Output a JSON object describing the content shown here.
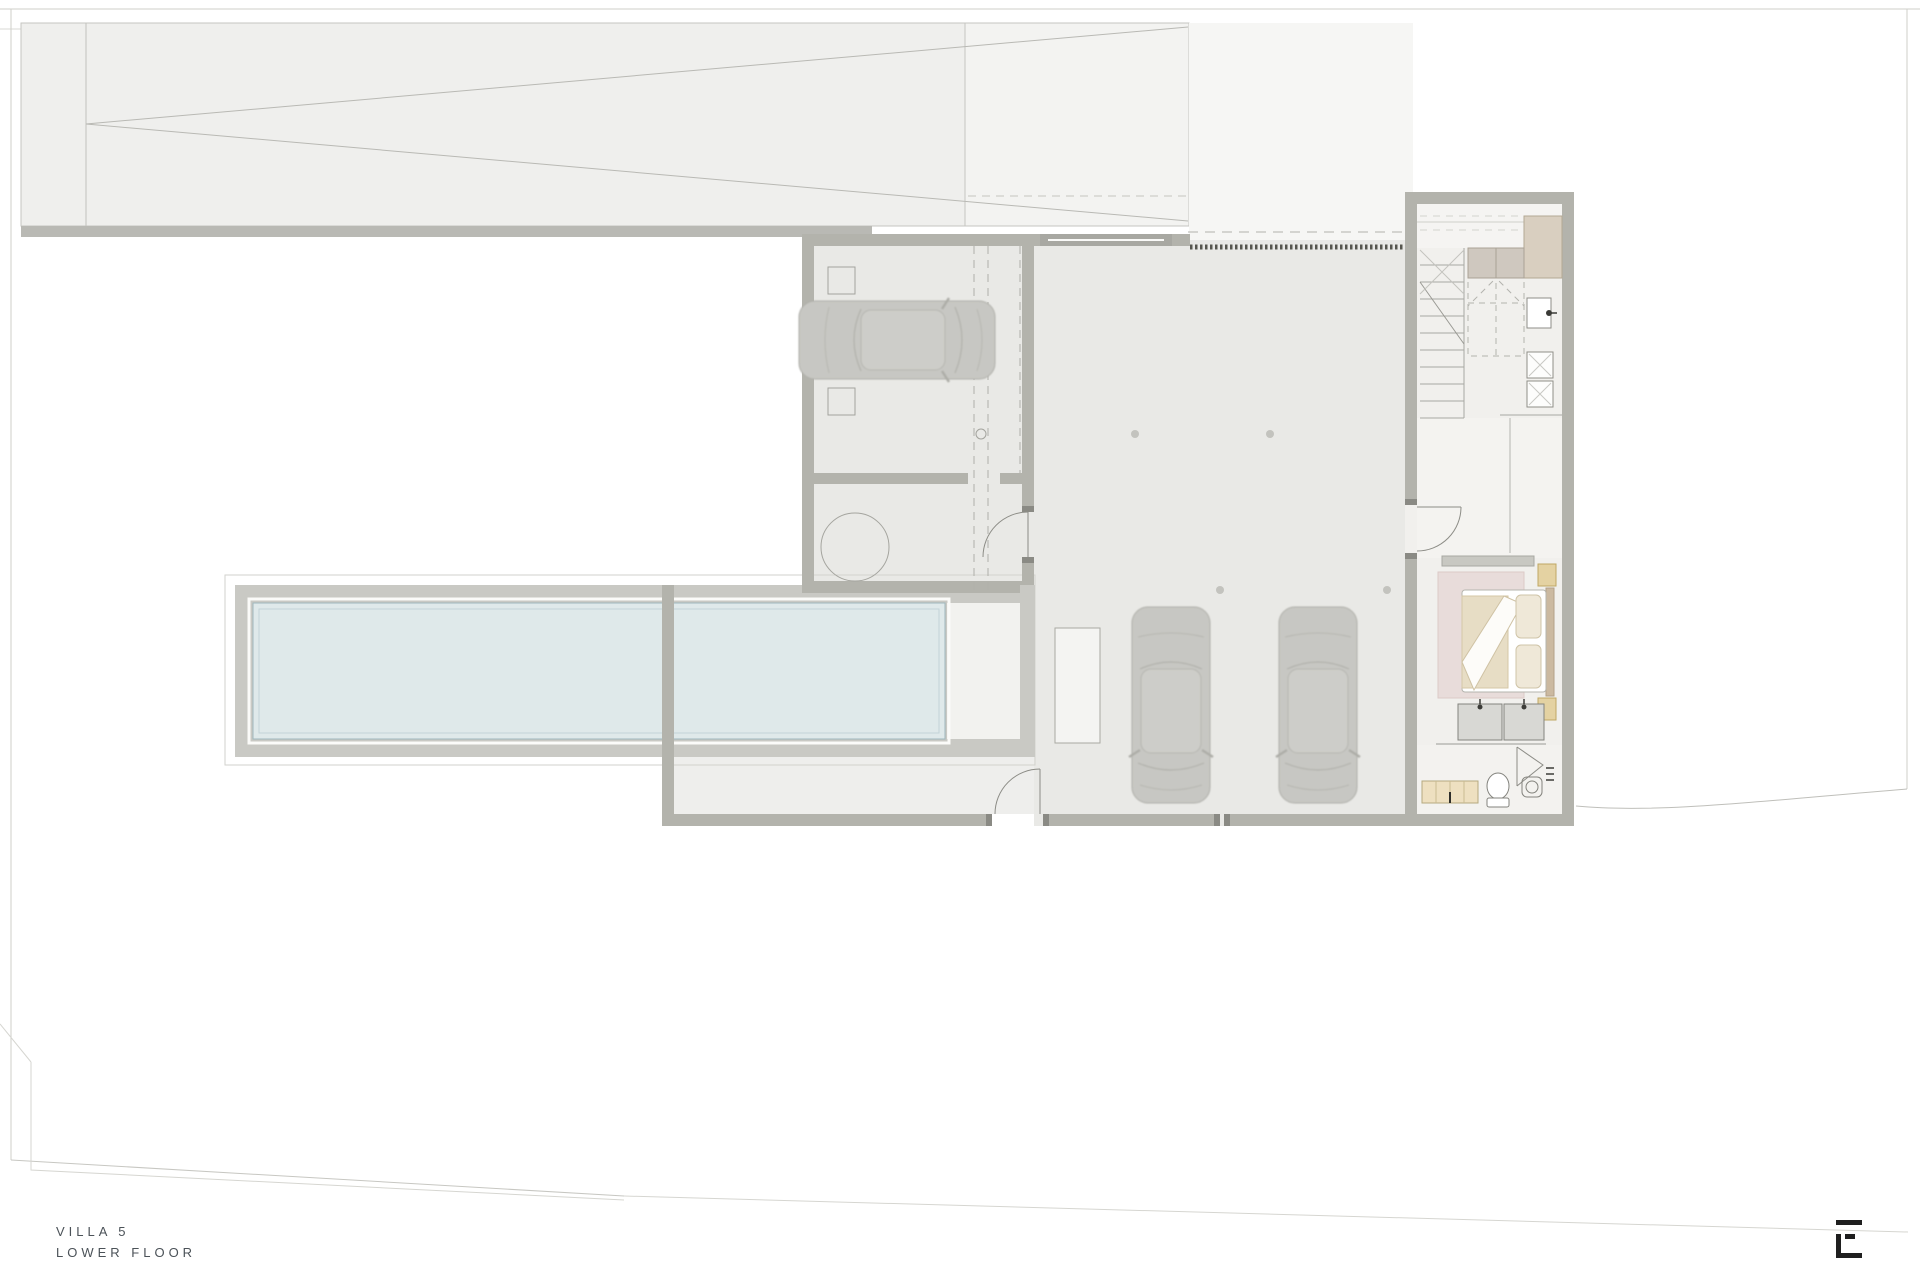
{
  "title_block": {
    "project": "VILLA 5",
    "floor": "LOWER FLOOR"
  },
  "logo": {
    "mark": "E-monogram"
  },
  "palette": {
    "wall": "#b3b3ac",
    "floor": "#e9e9e6",
    "floor_light": "#f1f0ed",
    "ramp": "#efefed",
    "forecourt": "#f3f3f1",
    "pool_water": "#dfe9ea",
    "pool_deck": "#c9c9c4",
    "rug": "#e8dcda",
    "blanket": "#e7ddc5",
    "wood_accent": "#e4d2a2",
    "bench": "#eee0c0",
    "line": "#a9a9a3",
    "grate": "#56564f",
    "text": "#4b5258",
    "logo": "#1f1f1f"
  },
  "plan": {
    "rooms": [
      "driveway-ramp",
      "entry-forecourt",
      "garage",
      "utility-room",
      "parking-court",
      "staircase",
      "laundry",
      "hallway",
      "bedroom",
      "bathroom",
      "pool-terrace"
    ],
    "furniture": [
      "car",
      "car",
      "car",
      "round-table",
      "bed",
      "nightstand",
      "nightstand",
      "vanity",
      "toilet",
      "washbasin",
      "bench",
      "washer",
      "dryer"
    ],
    "counts": {
      "cars": 3,
      "columns": 4,
      "stair_treads": 10,
      "door_swings": 5
    }
  }
}
